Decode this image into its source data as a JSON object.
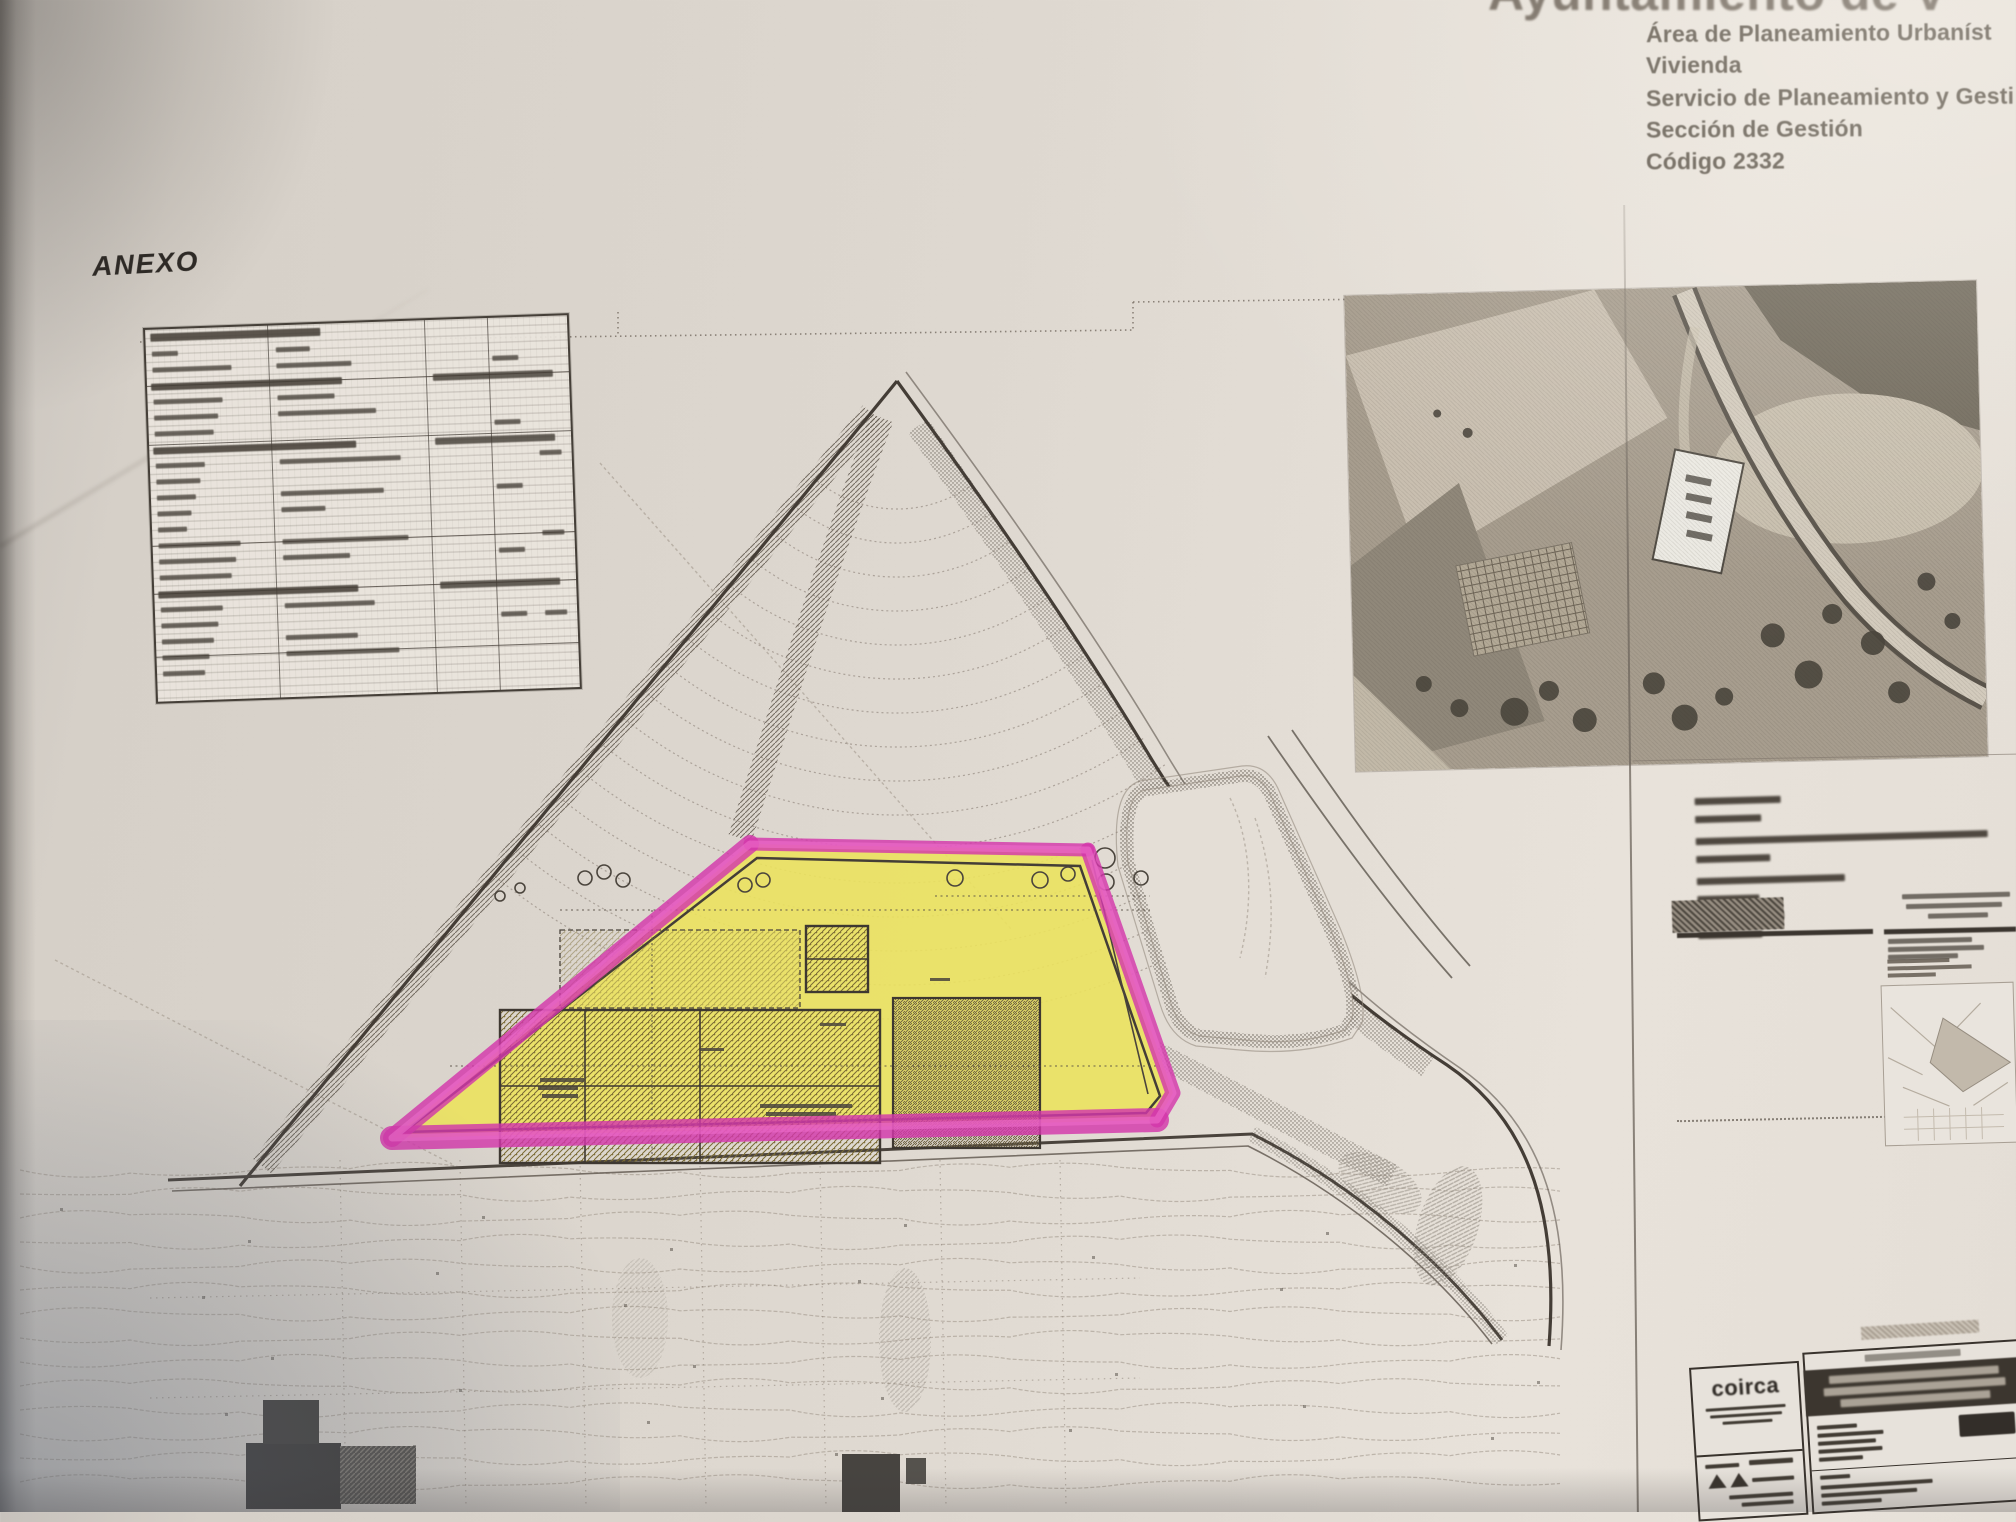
{
  "header": {
    "municipality_partial": "Ayuntamiento de V",
    "department": "Área de Planeamiento Urbaníst",
    "area": "Vivienda",
    "service": "Servicio de Planeamiento y Gesti",
    "section": "Sección de Gestión",
    "code": "Código 2332"
  },
  "annex": {
    "label": "ANEXO"
  },
  "title_block": {
    "logo_text": "coirca"
  },
  "colors": {
    "highlight_magenta": "#d337ab",
    "highlight_yellow": "#ebe25e",
    "plan_ink": "#443d36",
    "paper": "#ded8d0"
  }
}
